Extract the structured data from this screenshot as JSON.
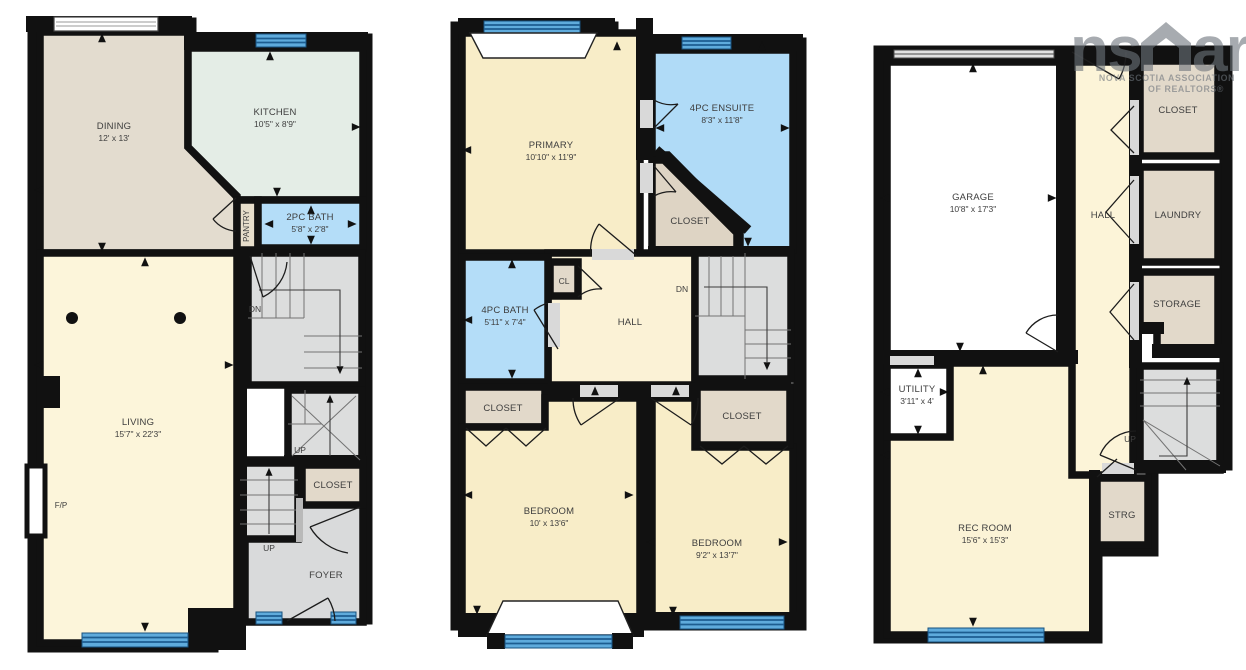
{
  "logo": {
    "ns": "ns",
    "ar": "ar",
    "assoc_line1": "NOVA SCOTIA ASSOCIATION",
    "assoc_line2": "OF REALTORS®"
  },
  "level1": {
    "dining": {
      "name": "DINING",
      "dims": "12' x 13'"
    },
    "kitchen": {
      "name": "KITCHEN",
      "dims": "10'5\" x 8'9\""
    },
    "pantry": {
      "name": "PANTRY"
    },
    "bath": {
      "name": "2PC BATH",
      "dims": "5'8\" x 2'8\""
    },
    "living": {
      "name": "LIVING",
      "dims": "15'7\" x 22'3\""
    },
    "fireplace": {
      "name": "F/P"
    },
    "stairs_dn": {
      "name": "DN"
    },
    "stairs_up": {
      "name": "UP"
    },
    "closet": {
      "name": "CLOSET"
    },
    "foyer_stairs_up": {
      "name": "UP"
    },
    "foyer": {
      "name": "FOYER"
    }
  },
  "level2": {
    "primary": {
      "name": "PRIMARY",
      "dims": "10'10\" x 11'9\""
    },
    "ensuite": {
      "name": "4PC ENSUITE",
      "dims": "8'3\" x 11'8\""
    },
    "walkin_closet": {
      "name": "CLOSET"
    },
    "cl": {
      "name": "CL"
    },
    "bath": {
      "name": "4PC BATH",
      "dims": "5'11\" x 7'4\""
    },
    "hall": {
      "name": "HALL"
    },
    "stairs_dn": {
      "name": "DN"
    },
    "closet_bed1": {
      "name": "CLOSET"
    },
    "bedroom1": {
      "name": "BEDROOM",
      "dims": "10' x 13'6\""
    },
    "bedroom2": {
      "name": "BEDROOM",
      "dims": "9'2\" x 13'7\""
    },
    "closet_bed2": {
      "name": "CLOSET"
    }
  },
  "level3": {
    "garage": {
      "name": "GARAGE",
      "dims": "10'8\" x 17'3\""
    },
    "hall": {
      "name": "HALL"
    },
    "closet": {
      "name": "CLOSET"
    },
    "laundry": {
      "name": "LAUNDRY"
    },
    "storage": {
      "name": "STORAGE"
    },
    "utility": {
      "name": "UTILITY",
      "dims": "3'11\" x 4'"
    },
    "stairs_up": {
      "name": "UP"
    },
    "strg": {
      "name": "STRG"
    },
    "rec_room": {
      "name": "REC ROOM",
      "dims": "15'6\" x 15'3\""
    }
  },
  "colors": {
    "wall": "#111111",
    "cream_room": "#f8edc8",
    "cream_light": "#fcf5da",
    "tan_room": "#e3dccf",
    "tan_closet": "#e2d9ca",
    "mint_room": "#e4ede6",
    "bath_blue": "#b4ddf8",
    "stair_gray": "#dcdddd",
    "window_blue": "#5fabdc",
    "logo_gray": "#b5b8bb"
  }
}
